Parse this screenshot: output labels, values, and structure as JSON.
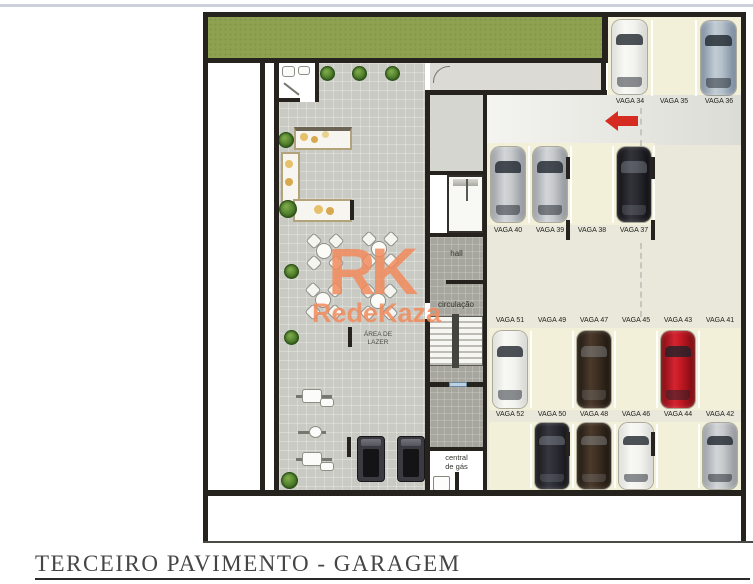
{
  "title_block": {
    "text": "TERCEIRO PAVIMENTO - GARAGEM"
  },
  "watermark": {
    "logo": "RK",
    "brand": "RedeKaza",
    "color": "#f18a5c"
  },
  "rooms": {
    "hall": "hall",
    "circulacao": "circulação",
    "area_lazer_line1": "ÁREA DE",
    "area_lazer_line2": "LAZER",
    "central_gas_line1": "central",
    "central_gas_line2": "de gás"
  },
  "parking": {
    "rows": [
      {
        "name": "entry-row",
        "spots": [
          {
            "id": "VAGA 34",
            "car": "white"
          },
          {
            "id": "VAGA 35",
            "car": ""
          },
          {
            "id": "VAGA 36",
            "car": "steel"
          }
        ]
      },
      {
        "name": "middle-row",
        "spots": [
          {
            "id": "VAGA 40",
            "car": "silver"
          },
          {
            "id": "VAGA 39",
            "car": "silver"
          },
          {
            "id": "VAGA 38",
            "car": ""
          },
          {
            "id": "VAGA 37",
            "car": "black"
          }
        ]
      },
      {
        "name": "tandem-front-row",
        "spots": [
          {
            "id": "VAGA 51",
            "car": "white"
          },
          {
            "id": "VAGA 49",
            "car": ""
          },
          {
            "id": "VAGA 47",
            "car": "brown"
          },
          {
            "id": "VAGA 45",
            "car": ""
          },
          {
            "id": "VAGA 43",
            "car": "red"
          },
          {
            "id": "VAGA 41",
            "car": ""
          }
        ]
      },
      {
        "name": "tandem-rear-row",
        "spots": [
          {
            "id": "VAGA 52",
            "car": ""
          },
          {
            "id": "VAGA 50",
            "car": "suv"
          },
          {
            "id": "VAGA 48",
            "car": "brown"
          },
          {
            "id": "VAGA 46",
            "car": "white"
          },
          {
            "id": "VAGA 44",
            "car": ""
          },
          {
            "id": "VAGA 42",
            "car": "silver"
          }
        ]
      }
    ]
  },
  "colors": {
    "garden": "#8ea150",
    "wall": "#26231f",
    "garage_floor": "#eae8db",
    "stall_floor": "#f3f0da",
    "leisure_floor": "#cacac4",
    "core_floor": "#a6a69e",
    "arrow_red": "#d52b20",
    "watermark_orange": "#f18a5c",
    "car_white": "#f2f2ef",
    "car_silver": "#b9bdc1",
    "car_steel": "#9fb2c0",
    "car_black": "#1d1d21",
    "car_red": "#bb1a1f",
    "car_brown": "#3d2f24",
    "car_suv": "#27272b"
  }
}
